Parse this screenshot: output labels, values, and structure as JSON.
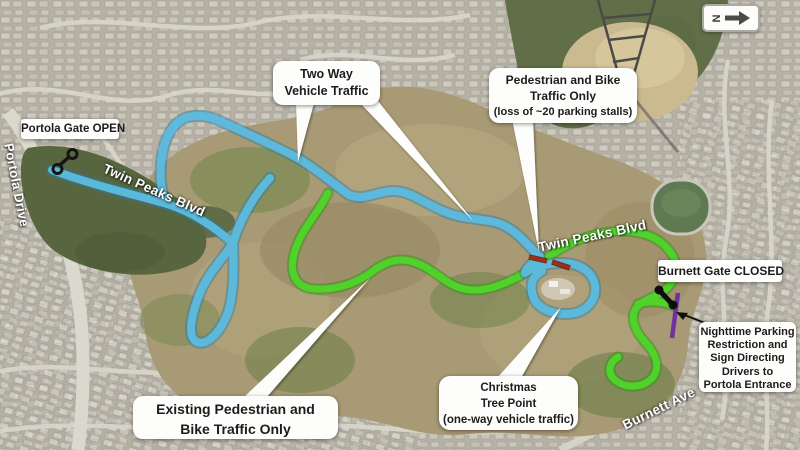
{
  "map_title": "Twin Peaks Blvd traffic changes aerial map",
  "compass": {
    "label": "N"
  },
  "callouts": {
    "portola_gate": {
      "label": "Portola Gate OPEN"
    },
    "two_way": {
      "line1": "Two Way",
      "line2": "Vehicle Traffic"
    },
    "ped_bike": {
      "line1": "Pedestrian and Bike",
      "line2": "Traffic Only",
      "line3": "(loss of ~20 parking stalls)"
    },
    "burnett_gate": {
      "label": "Burnett Gate CLOSED"
    },
    "nighttime": {
      "line1": "Nighttime Parking",
      "line2": "Restriction and",
      "line3": "Sign Directing",
      "line4": "Drivers to",
      "line5": "Portola Entrance"
    },
    "christmas": {
      "line1": "Christmas",
      "line2": "Tree Point",
      "line3": "(one-way vehicle traffic)"
    },
    "existing": {
      "line1": "Existing Pedestrian and",
      "line2": "Bike Traffic Only"
    }
  },
  "streets": {
    "portola_drive": "Portola Drive",
    "twin_peaks_blvd_west": "Twin Peaks Blvd",
    "twin_peaks_blvd_east": "Twin Peaks Blvd",
    "burnett_ave": "Burnett Ave"
  },
  "legend_colors": {
    "two_way_route": "#5cbce0",
    "ped_bike_route": "#4fd32b",
    "parking_removal_marker": "#a62c10",
    "nighttime_restriction_marker": "#7030a0",
    "gate_marker": "#0d0d0d"
  }
}
